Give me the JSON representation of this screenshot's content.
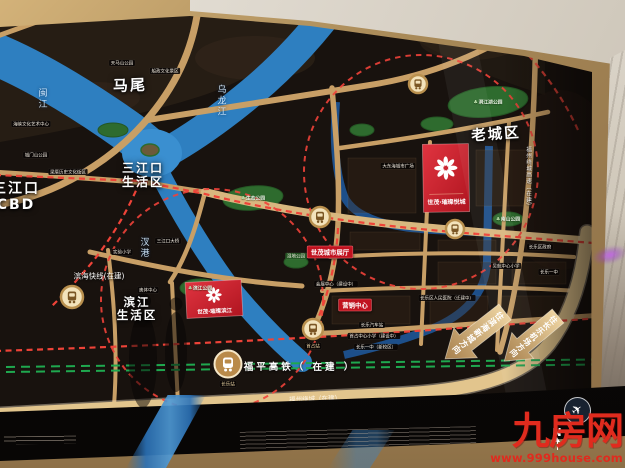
{
  "colors": {
    "project_red": "#cf1f2a",
    "marker_red": "#c1121f",
    "road_gold": "#c89f66",
    "highway_gold": "#e2c58d",
    "water_blue": "#2e7fc0",
    "canal_blue": "#1d4f8a",
    "park_green": "#2e6b2e",
    "metro_red": "#ee4338",
    "rail_green": "#1fa84f",
    "watermark_red": "#e02b1e",
    "marble": "#d5cec2"
  },
  "park_icon": "♣",
  "watermark": {
    "site_name": "九房网",
    "site_url": "www.999house.com"
  },
  "map": {
    "compass": "N",
    "airplane_icon": "✈",
    "districts": [
      {
        "id": "mawei",
        "text": "马尾",
        "x": 130,
        "y": 86,
        "size": 15,
        "rot": -2
      },
      {
        "id": "sanjiangkou-life",
        "text": "三江口\n生活区",
        "x": 143,
        "y": 176,
        "size": 12,
        "rot": 0
      },
      {
        "id": "sanjiangkou-cbd",
        "text": "三江口\nCBD",
        "x": 16,
        "y": 197,
        "size": 14,
        "rot": 0
      },
      {
        "id": "old-town",
        "text": "老城区",
        "x": 496,
        "y": 135,
        "size": 14.5,
        "rot": -4
      },
      {
        "id": "binjiang-life",
        "text": "滨江\n生活区",
        "x": 137,
        "y": 309,
        "size": 11.5,
        "rot": 0
      }
    ],
    "rivers": [
      {
        "name": "闽江",
        "x": 42,
        "y": 99
      },
      {
        "name": "乌龙江",
        "x": 221,
        "y": 101
      },
      {
        "name": "汊港",
        "x": 144,
        "y": 248
      }
    ],
    "projects": [
      {
        "id": "yuecheng",
        "name": "世茂·璀璨悦城"
      },
      {
        "id": "binjiang",
        "name": "世茂·璀璨滨江"
      }
    ],
    "markers": [
      {
        "text": "世茂城市展厅",
        "x": 330,
        "y": 252
      },
      {
        "text": "营销中心",
        "x": 355,
        "y": 305
      }
    ],
    "transit": {
      "rail_label": "福平高铁（ 在建 ）",
      "rail_station": "长乐站",
      "metro_station": "首占站",
      "metro_label": "滨海快线(在建)",
      "ring_label": "福州绕城（在建）",
      "expressway_vertical": "福州绕城高速（在建）",
      "road_name": "营滨路"
    },
    "arrows": [
      {
        "text": "往滨海新城方向"
      },
      {
        "text": "往长乐机场方向"
      }
    ],
    "parks": [
      {
        "text": "洞江湖公园",
        "x": 488,
        "y": 102
      },
      {
        "text": "生态公园",
        "x": 253,
        "y": 198
      },
      {
        "text": "滨江公园",
        "x": 200,
        "y": 288
      },
      {
        "text": "南山公园",
        "x": 508,
        "y": 219
      }
    ],
    "pois": [
      {
        "text": "天马山公园",
        "x": 122,
        "y": 63
      },
      {
        "text": "船政文化景区",
        "x": 165,
        "y": 71
      },
      {
        "text": "海峡文化艺术中心",
        "x": 31,
        "y": 124
      },
      {
        "text": "城门山公园",
        "x": 36,
        "y": 155
      },
      {
        "text": "梁厝历史文化街区",
        "x": 68,
        "y": 172
      },
      {
        "text": "三江口大桥",
        "x": 168,
        "y": 241
      },
      {
        "text": "实验小学",
        "x": 122,
        "y": 252
      },
      {
        "text": "奥体中心",
        "x": 148,
        "y": 290
      },
      {
        "text": "大东海城市广场",
        "x": 398,
        "y": 166
      },
      {
        "text": "长乐区政府",
        "x": 540,
        "y": 247
      },
      {
        "text": "吴航中心小学",
        "x": 506,
        "y": 266
      },
      {
        "text": "长乐一中",
        "x": 549,
        "y": 272
      },
      {
        "text": "会展中心（建设中）",
        "x": 336,
        "y": 284
      },
      {
        "text": "长乐区人民医院（迁建中）",
        "x": 447,
        "y": 298
      },
      {
        "text": "长乐汽车站",
        "x": 372,
        "y": 325
      },
      {
        "text": "首占中心小学（建设中）",
        "x": 374,
        "y": 336
      },
      {
        "text": "长乐一中（新校区）",
        "x": 376,
        "y": 347
      },
      {
        "text": "湿地公园",
        "x": 296,
        "y": 256,
        "green": true
      }
    ]
  }
}
